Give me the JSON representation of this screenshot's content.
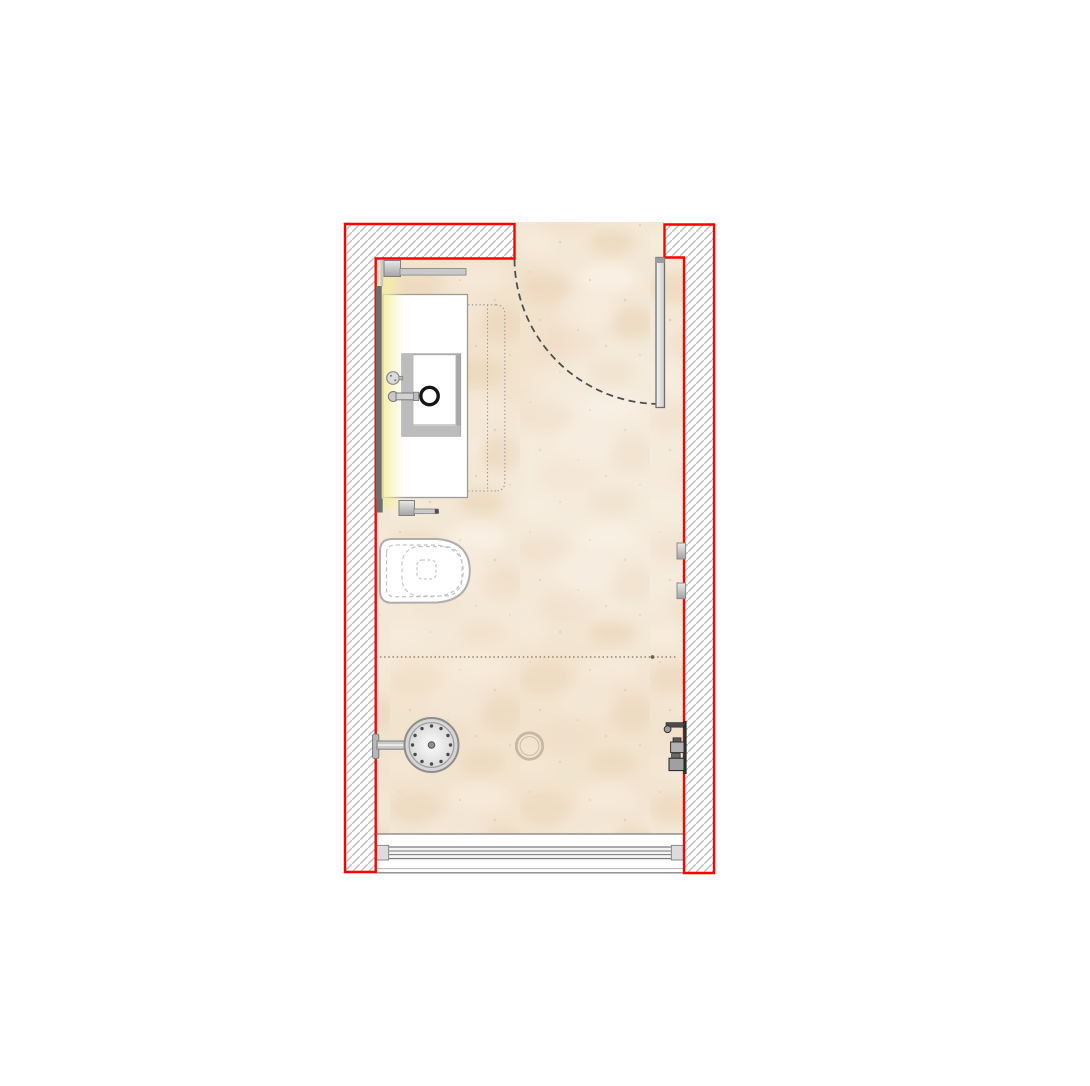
{
  "window": {
    "background": "#ffffff",
    "width_px": 1090,
    "height_px": 1086
  },
  "palette": {
    "wall_outline": "#ff0000",
    "hatch_line": "#bdbdbd",
    "floor_base": "#f3e8d6",
    "floor_mottle_dark": "#e9d2b4",
    "floor_mottle_light": "#f8f1e6",
    "fixture_stroke": "#8a8a8a",
    "counter_fill": "#ffffff",
    "mirror_fill": "#6e6e6e",
    "light_glow": "#f3e98c",
    "door_leaf_fill": "#e6e6e6",
    "swing_arc": "#4f4f4f",
    "black_drain_ring": "#151515",
    "floor_drain_ring": "#c6b9a2",
    "controls_dark": "#2e2e2e",
    "dotted_guide": "#9a9a9a",
    "shower_zone_dots": "#a3937d"
  },
  "drawing": {
    "type": "bathroom-floor-plan",
    "view": "top-down architectural plan",
    "walls": {
      "outline_color": "#ff0000",
      "hatch_style": "diagonal-line hatching",
      "door_opening_location": "top wall, right side",
      "layout": "narrow rectangular room"
    },
    "floor": {
      "finish_look": "beige stone / marble mottle",
      "base_color": "#f3e8d6"
    },
    "door": {
      "state": "shown open 90 degrees with dashed swing arc",
      "hinge": "top-right jamb"
    },
    "fixtures": [
      "entry-door-leaf",
      "door-swing-arc",
      "towel-rail-upper",
      "mirror-with-backlight",
      "vanity-counter",
      "sink-basin",
      "basin-drain-ring",
      "wall-mounted-faucet",
      "faucet-handle",
      "dotted-counter-extension",
      "towel-rail-lower",
      "wall-hung-toilet",
      "shower-zone-dotted-boundary",
      "overhead-shower-head",
      "shower-wall-arm",
      "floor-drain",
      "hand-shower-holder",
      "shower-mixer-valves",
      "glass-panel-brackets",
      "sliding-glass-door-track",
      "entry-threshold"
    ]
  }
}
